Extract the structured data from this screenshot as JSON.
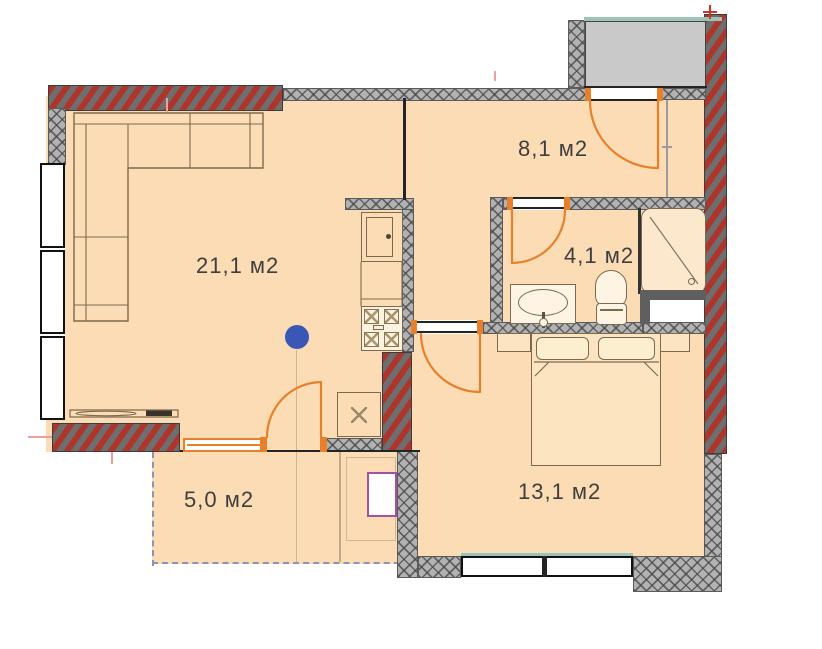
{
  "plan": {
    "rooms": {
      "living": {
        "area_label": "21,1 м2"
      },
      "hallway": {
        "area_label": "8,1 м2"
      },
      "bathroom": {
        "area_label": "4,1 м2"
      },
      "bedroom": {
        "area_label": "13,1 м2"
      },
      "balcony": {
        "area_label": "5,0 м2"
      }
    },
    "marker": {
      "name": "location-marker",
      "color": "#3b57b5"
    },
    "colors": {
      "floor": "#fbdcb5",
      "load_bearing_wall_red": "#ad352c",
      "partition_wall_gray": "#b2b2b2",
      "door_orange": "#e8802b",
      "window_glass_teal": "#9cc3b8",
      "landing_fill": "#c9c9c9",
      "balcony_dashed": "#8a93b8",
      "furniture_line": "#7d6a4e",
      "label_text": "#3e3e3e",
      "utility_box_border": "#a352a3"
    }
  }
}
